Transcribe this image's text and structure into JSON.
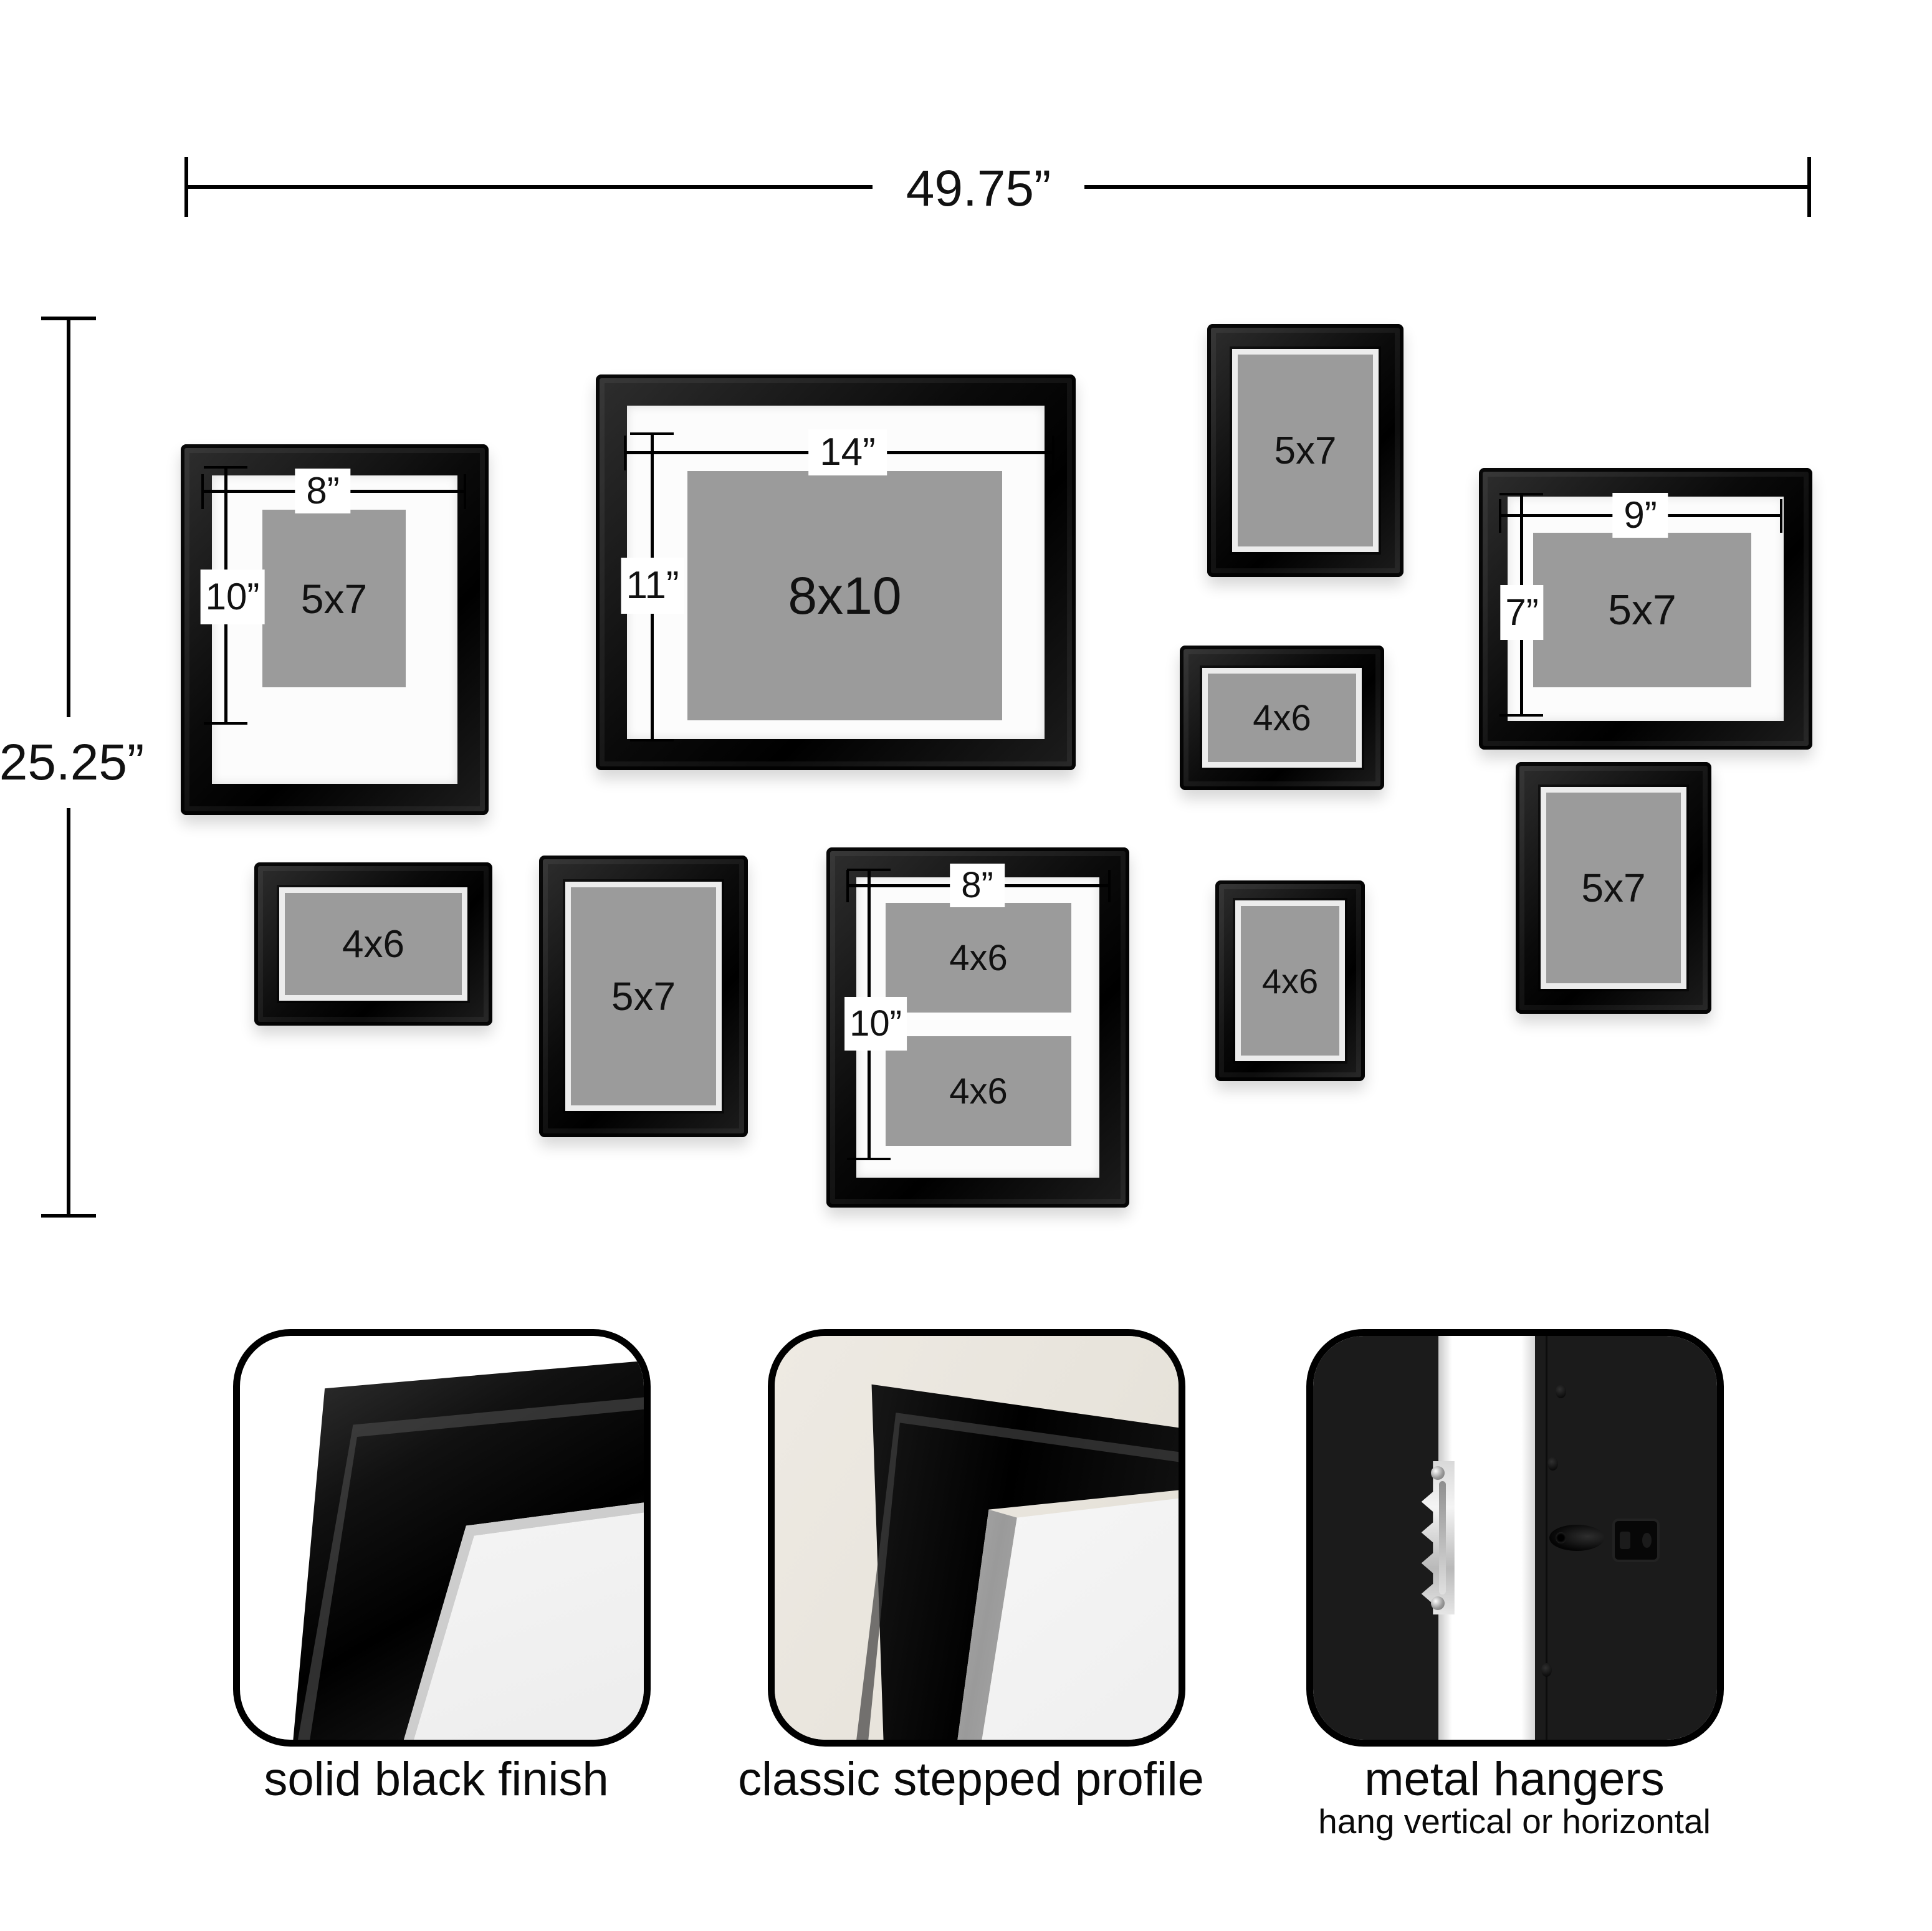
{
  "overall_dims": {
    "width_label": "49.75”",
    "height_label": "25.25”"
  },
  "frames": {
    "matted_5x7_left": {
      "photo_label": "5x7",
      "mat_width_label": "8”",
      "mat_height_label": "10”"
    },
    "matted_8x10": {
      "photo_label": "8x10",
      "mat_width_label": "14”",
      "mat_height_label": "11”"
    },
    "plain_5x7_top": {
      "photo_label": "5x7"
    },
    "matted_5x7_right": {
      "photo_label": "5x7",
      "mat_width_label": "9”",
      "mat_height_label": "7”"
    },
    "plain_4x6_mid": {
      "photo_label": "4x6"
    },
    "plain_4x6_bottom_left": {
      "photo_label": "4x6"
    },
    "plain_5x7_bottom": {
      "photo_label": "5x7"
    },
    "matted_double_4x6": {
      "photo_label_top": "4x6",
      "photo_label_bottom": "4x6",
      "mat_width_label": "8”",
      "mat_height_label": "10”"
    },
    "plain_4x6_portrait": {
      "photo_label": "4x6"
    },
    "plain_5x7_right": {
      "photo_label": "5x7"
    }
  },
  "features": {
    "finish": {
      "caption": "solid black finish"
    },
    "profile": {
      "caption": "classic stepped profile"
    },
    "hangers": {
      "caption": "metal hangers",
      "subcaption": "hang vertical or horizontal"
    }
  },
  "colors": {
    "background": "#ffffff",
    "frame_black": "#0d0d0d",
    "mat_white": "#fcfcfc",
    "photo_gray": "#9b9b9b",
    "wall_beige": "#e9e5dd",
    "text": "#111111"
  }
}
